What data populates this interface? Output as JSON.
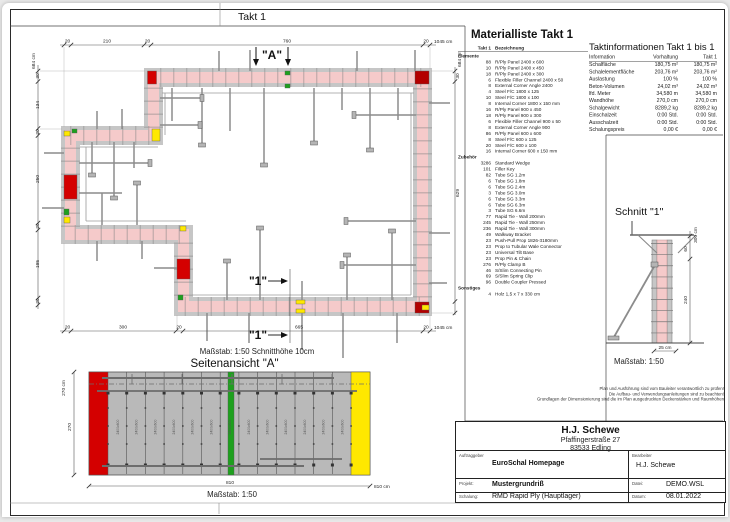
{
  "plan": {
    "title": "Takt 1",
    "section_a": "\"A\"",
    "section_1": "\"1\"",
    "scale_note": "Maßstab: 1:50   Schnitthöhe 10cm",
    "dims_top": [
      "20",
      "210",
      "20",
      "760",
      "20",
      "1045 cm"
    ],
    "dims_bottom": [
      "20",
      "300",
      "20",
      "665",
      "20",
      "1045 cm"
    ],
    "dims_left": [
      "684 cm",
      "30",
      "134",
      "20",
      "250",
      "20",
      "195",
      "20"
    ],
    "dims_right": [
      "684 cm",
      "30",
      "629"
    ]
  },
  "materialliste": {
    "title": "Materialliste  Takt 1",
    "col_takt": "Takt 1",
    "col_bez": "Bezeichnung",
    "groups": [
      {
        "name": "Elemente",
        "items": [
          [
            "88",
            "R/Ply Panel 2400 x 600"
          ],
          [
            "10",
            "R/Ply Panel 2400 x 450"
          ],
          [
            "18",
            "R/Ply Panel 2400 x 300"
          ],
          [
            "6",
            "Flexible Filler Channel 2400 x 50"
          ],
          [
            "8",
            "External Corner Angle 2400"
          ],
          [
            "4",
            "Steel F/C 1800 x 125"
          ],
          [
            "10",
            "Steel F/C 1800 x 100"
          ],
          [
            "8",
            "Internal Corner 1800 x 150 mm"
          ],
          [
            "16",
            "R/Ply Panel 900 x 450"
          ],
          [
            "18",
            "R/Ply Panel 900 x 300"
          ],
          [
            "6",
            "Flexible Filler Channel 900 x 50"
          ],
          [
            "8",
            "External Corner Angle 900"
          ],
          [
            "86",
            "R/Ply Panel 600 x 600"
          ],
          [
            "8",
            "Steel F/C 600 x 125"
          ],
          [
            "20",
            "Steel F/C 600 x 100"
          ],
          [
            "16",
            "Internal Corner 600 x 150 mm"
          ]
        ]
      },
      {
        "name": "Zubehör",
        "items": [
          [
            "3286",
            "Standard Wedge"
          ],
          [
            "101",
            "Filler Key"
          ],
          [
            "82",
            "Tube SG 1.2m"
          ],
          [
            "6",
            "Tube SG 1.8m"
          ],
          [
            "6",
            "Tube SG 2.4m"
          ],
          [
            "3",
            "Tube SG 3.0m"
          ],
          [
            "6",
            "Tube SG 3.3m"
          ],
          [
            "6",
            "Tube SG 6.3m"
          ],
          [
            "3",
            "Tube SG 6.6m"
          ],
          [
            "77",
            "Rapid Tie - Wall  200mm"
          ],
          [
            "245",
            "Rapid Tie - Wall  250mm"
          ],
          [
            "236",
            "Rapid Tie - Wall  300mm"
          ],
          [
            "49",
            "Walkway Bracket"
          ],
          [
            "23",
            "Push-Pull Prop 1826-3180mm"
          ],
          [
            "23",
            "Prop to Tubular Wale Connector"
          ],
          [
            "23",
            "Universal Tilt Base"
          ],
          [
            "23",
            "Prop Pin & Chain"
          ],
          [
            "276",
            "R/Ply Clamp B"
          ],
          [
            "46",
            "S/Slim Connecting Pin"
          ],
          [
            "69",
            "S/Slim Spring Clip"
          ],
          [
            "96",
            "Double Coupler Pressed"
          ]
        ]
      },
      {
        "name": "Sonstiges",
        "items": [
          [
            "4",
            "Holz 1,5 x 7 x 330 cm"
          ]
        ]
      }
    ]
  },
  "taktinfo": {
    "title": "Taktinformationen  Takt 1 bis 1",
    "cols": [
      "Information",
      "Vorhaltung",
      "Takt 1"
    ],
    "rows": [
      [
        "Schalfläche",
        "180,75 m²",
        "180,75 m²"
      ],
      [
        "Schalelementfläche",
        "203,76 m²",
        "203,76 m²"
      ],
      [
        "Auslastung",
        "100 %",
        "100 %"
      ],
      [
        "Beton-Volumen",
        "24,02 m³",
        "24,02 m³"
      ],
      [
        "lfd. Meter",
        "34,580 m",
        "34,580 m"
      ],
      [
        "Wandhöhe",
        "270,0 cm",
        "270,0 cm"
      ],
      [
        "Schalgewicht",
        "8289,2 kg",
        "8289,2 kg"
      ],
      [
        "Einschalzeit",
        "0:00 Std.",
        "0:00 Std."
      ],
      [
        "Ausschalzeit",
        "0:00 Std.",
        "0:00 Std."
      ],
      [
        "Schalungspreis",
        "0,00 €",
        "0,00 €"
      ]
    ]
  },
  "schnitt": {
    "title": "Schnitt \"1\"",
    "scale": "Maßstab: 1:50",
    "dim_total": "300 cm",
    "dim_top": "60",
    "dim_bottom": "240",
    "dim_width": "25 cm"
  },
  "side_view": {
    "title": "Seitenansicht \"A\"",
    "scale": "Maßstab: 1:50",
    "dim_left_outer": "270 cm",
    "dim_left_inner": "270",
    "dim_bottom": "810",
    "dim_bottom_total": "810 cm",
    "panel_label": "2400x600",
    "panel_count": 13
  },
  "disclaimer": [
    "Plan und Ausführung sind vom Bauleiter verantwortlich zu prüfen!",
    "Die Aufbau- und Verwendungsanleitungen sind zu beachten!",
    "Grundlagen der Dimensionierung sind die im Plan ausgedruckten Deckenstärken und Raumhöhen"
  ],
  "title_block": {
    "company": "H.J. Schewe",
    "street": "Pfaffingerstraße 27",
    "city": "83533 Edling",
    "fields": [
      {
        "label": "Auftraggeber",
        "value": "EuroSchal Homepage"
      },
      {
        "label": "Bearbeiter",
        "value": "H.J. Schewe"
      },
      {
        "label": "Projekt:",
        "value": "Mustergrundriß"
      },
      {
        "label": "Datei:",
        "value": "DEMO.WSL"
      },
      {
        "label": "Schalung:",
        "value": "RMD Rapid Ply (Hauptlager)"
      },
      {
        "label": "Datum:",
        "value": "08.01.2022"
      }
    ]
  },
  "colors": {
    "wall_fill": "#f5caca",
    "formwork_gray": "#c6c6c6",
    "tick_gray": "#8a8a8a",
    "panel_red": "#d40000",
    "panel_yellow": "#ffe800",
    "panel_green": "#1ea01e"
  }
}
